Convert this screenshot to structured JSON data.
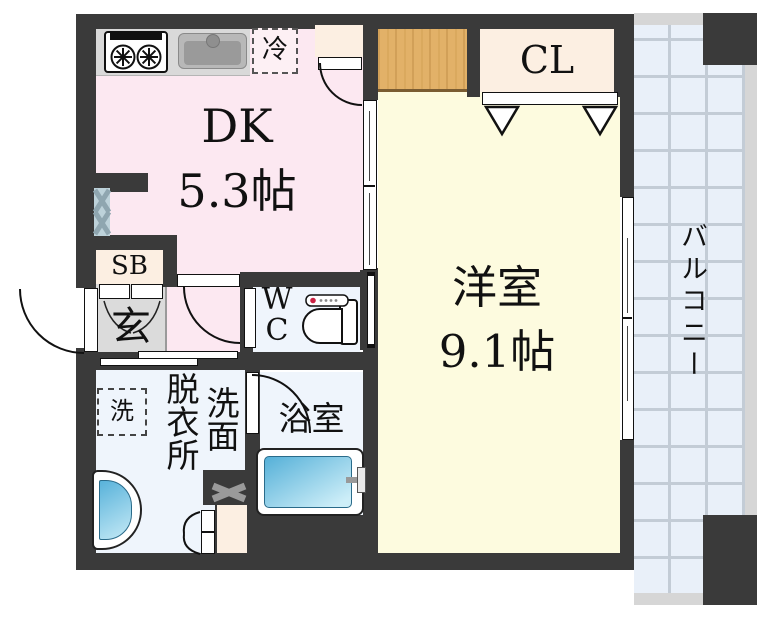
{
  "labels": {
    "dk_name": "DK",
    "dk_size": "5.3帖",
    "western_name": "洋室",
    "western_size": "9.1帖",
    "closet": "CL",
    "balcony": "バルコニー",
    "shoe_box": "SB",
    "entrance": "玄",
    "wc_w": "W",
    "wc_c": "C",
    "dressing_room": "脱衣所",
    "washstand": "洗面",
    "bathroom": "浴室",
    "washer": "洗",
    "refrigerator": "冷"
  },
  "colors": {
    "wall": "#3a3a3a",
    "dk_floor": "#fce8f1",
    "western_floor": "#fdfbdf",
    "wet_floor": "#eff5fc",
    "balcony_tile": "#e9f0f9",
    "balcony_grid": "#c3ccd6",
    "balcony_edge": "#d6d6d6",
    "storage_cream": "#fcefe2",
    "entrance_gray": "#dbdbdb",
    "wood_counter": "#e2b168",
    "water_blue_dark": "#55b0d8",
    "water_blue_light": "#cdeef8",
    "fridge_box_bg": "#fdf0f4"
  }
}
